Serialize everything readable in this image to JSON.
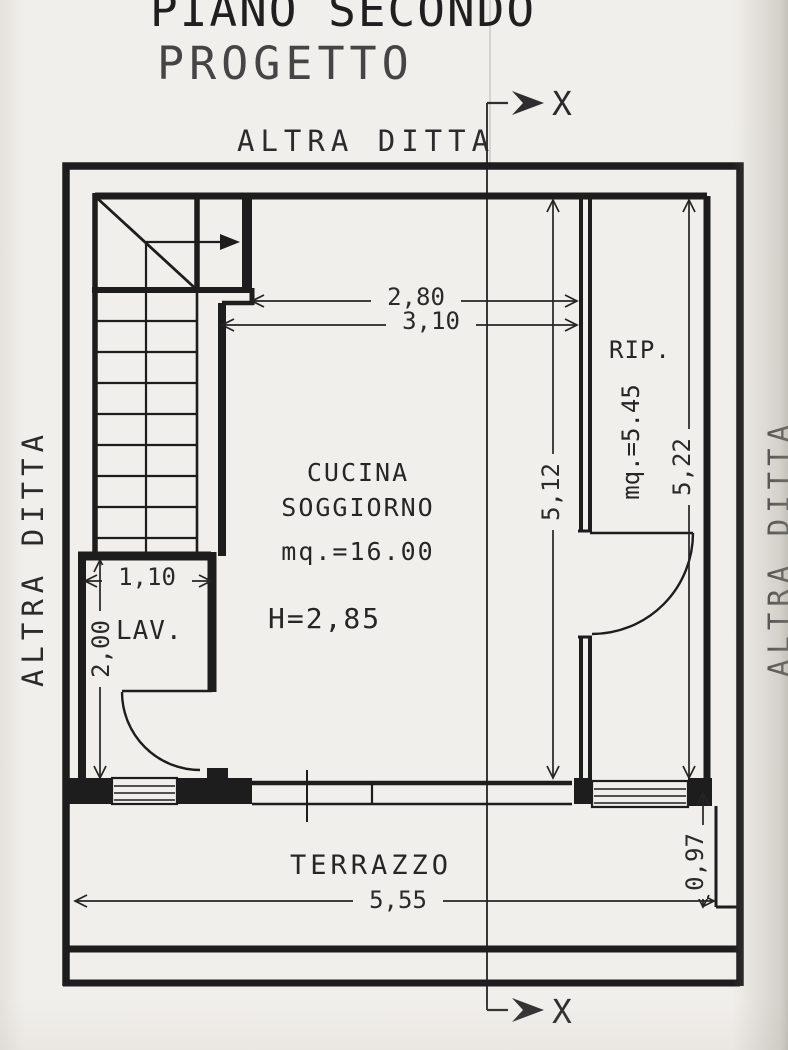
{
  "title": {
    "line1": "PIANO SECONDO",
    "line2": "PROGETTO"
  },
  "neighbors": {
    "top": "ALTRA DITTA",
    "left": "ALTRA DITTA",
    "right": "ALTRA DITTA"
  },
  "section": {
    "marker": "X"
  },
  "rooms": {
    "kitchen": {
      "name_line1": "CUCINA",
      "name_line2": "SOGGIORNO",
      "area": "mq.=16.00",
      "ceiling_height": "H=2,85"
    },
    "storage": {
      "name": "RIP.",
      "area": "mq.=5.45"
    },
    "laundry": {
      "name": "LAV."
    },
    "terrace": {
      "name": "TERRAZZO"
    }
  },
  "dimensions": {
    "kitchen_width_inner": "2,80",
    "kitchen_width_outer": "3,10",
    "kitchen_depth": "5,12",
    "storage_depth": "5,22",
    "laundry_width": "1,10",
    "laundry_depth": "2,00",
    "terrace_width": "5,55",
    "terrace_side_depth": "0,97"
  }
}
